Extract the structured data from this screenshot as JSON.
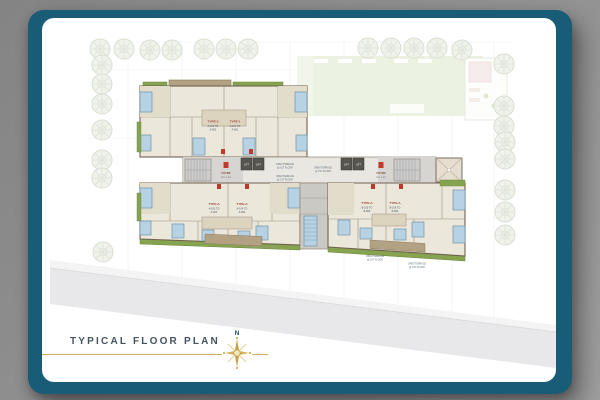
{
  "frame": {
    "title": "TYPICAL FLOOR PLAN",
    "compass_north": "N"
  },
  "colors": {
    "frame_teal": "#195c78",
    "card_white": "#ffffff",
    "backdrop_gray": "#8f8f8f",
    "gold": "#c9a23f",
    "title_text": "#44535f",
    "lawn_green": "#dce8cb",
    "planter_green": "#86a44f",
    "window_blue": "#b7d2e2",
    "deck_tan": "#b3a183",
    "wall_taupe": "#6f6250",
    "marker_red": "#c0392b",
    "road_gray": "#e8e8ea"
  },
  "units": [
    {
      "type": "TYPE-2",
      "range1": "A-102 TO",
      "range2": "A-902"
    },
    {
      "type": "TYPE-1",
      "range1": "A-101 TO",
      "range2": "A-901"
    },
    {
      "type": "TYPE-A",
      "range1": "A-103 TO",
      "range2": "A-903"
    },
    {
      "type": "TYPE-A",
      "range1": "A-104 TO",
      "range2": "A-904"
    },
    {
      "type": "TYPE-A",
      "range1": "B-105 TO",
      "range2": "B-905"
    },
    {
      "type": "TYPE-A",
      "range1": "B-106 TO",
      "range2": "B-906"
    }
  ],
  "core": {
    "lift_label": "LIFT",
    "foyer_label": "FOYER",
    "foyer_dim": "12'0\" X 8'0\""
  },
  "terrace": {
    "line1": "OPEN TERRACE",
    "line2": "@ 1ST FLOOR",
    "edge_note": "OPEN TERRACE @ 1ST FLOOR"
  }
}
